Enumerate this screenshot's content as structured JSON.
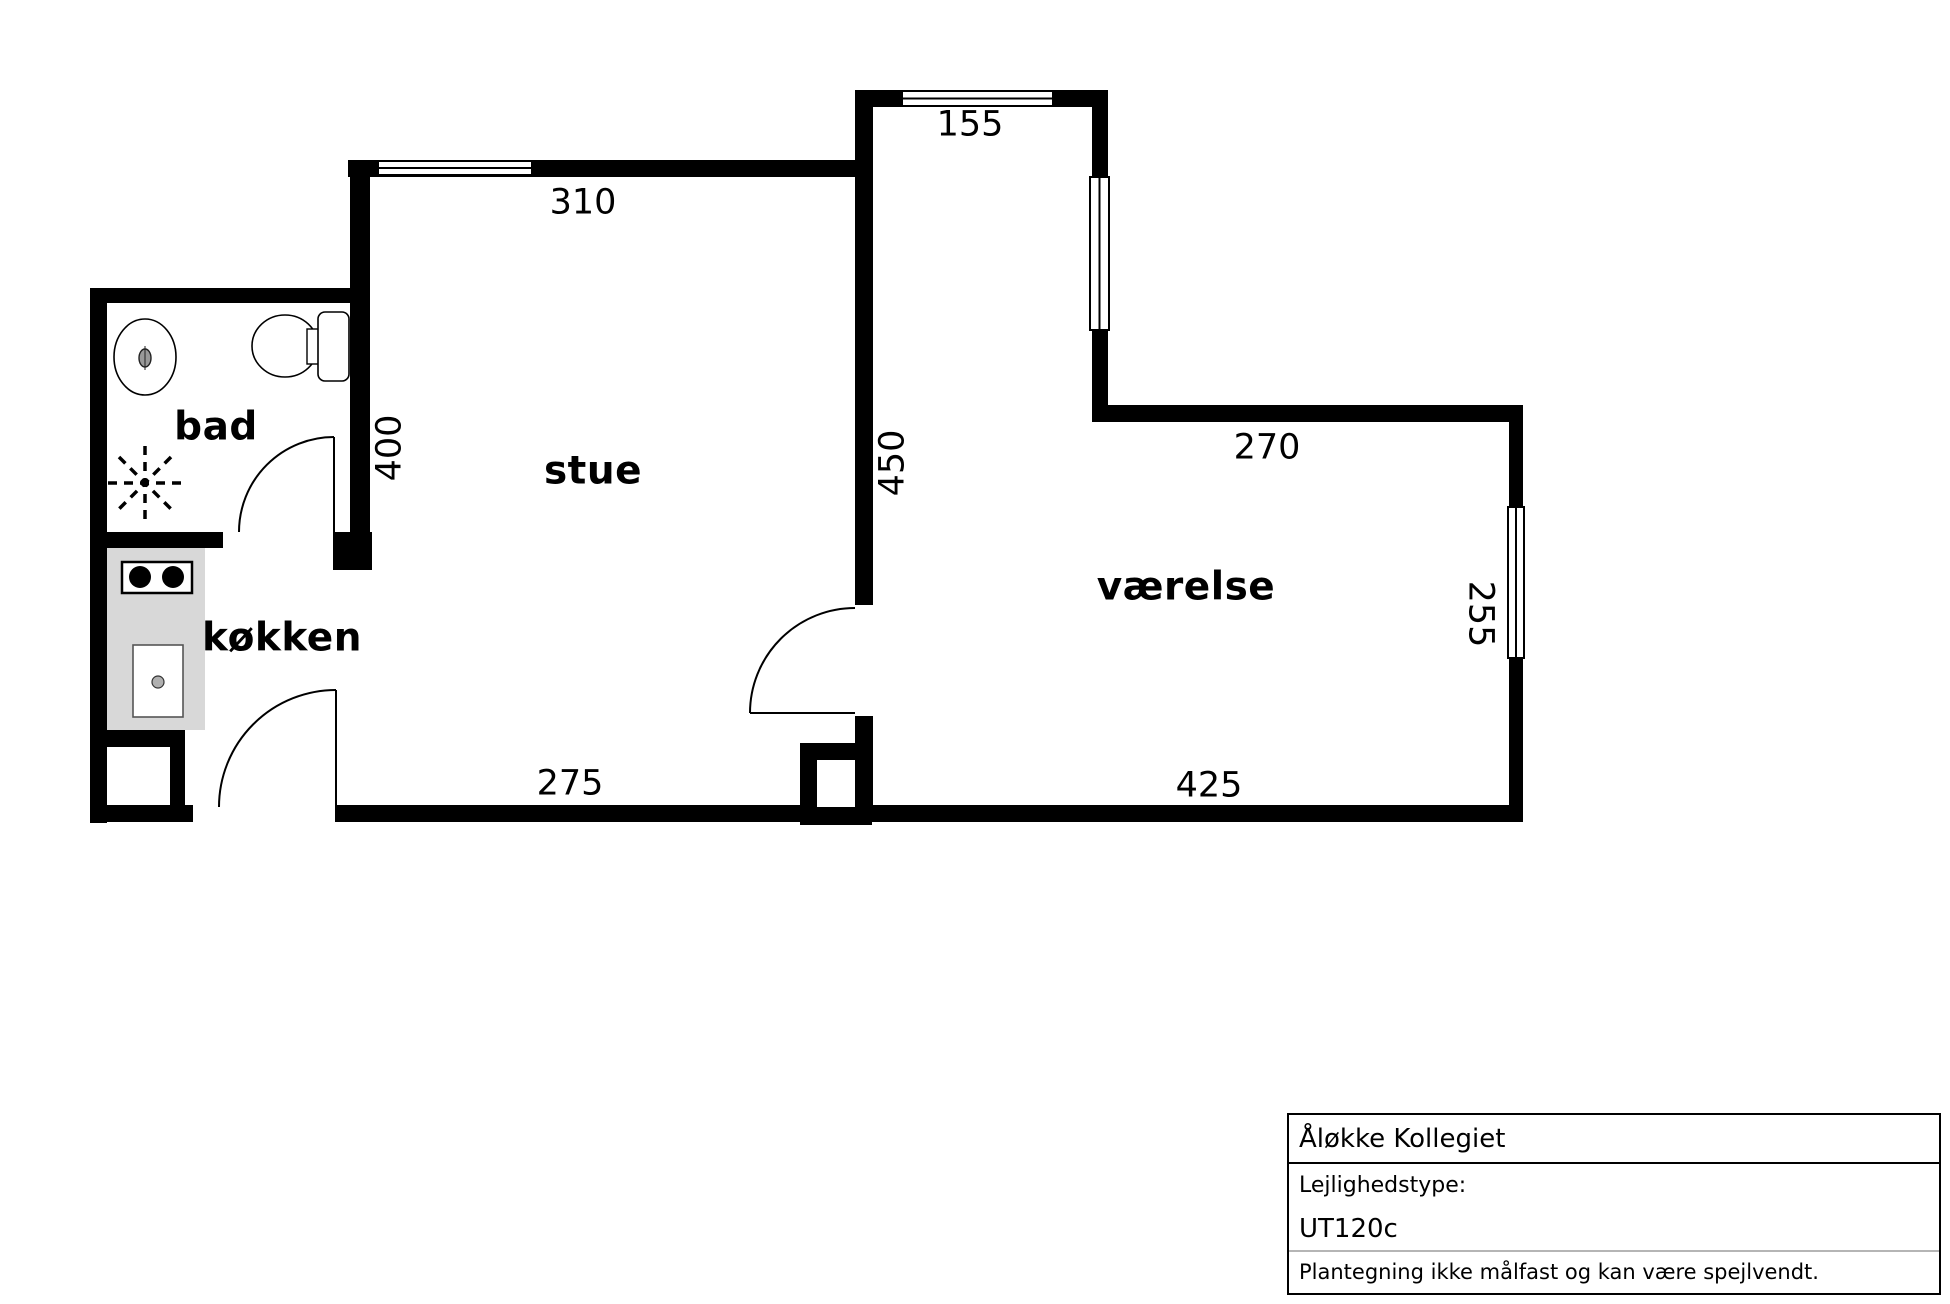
{
  "document": {
    "kind": "apartment-floor-plan"
  },
  "plan": {
    "rooms": [
      {
        "label": "bad"
      },
      {
        "label": "stue"
      },
      {
        "label": "køkken"
      },
      {
        "label": "værelse"
      }
    ],
    "dims": [
      {
        "text": "310"
      },
      {
        "text": "155"
      },
      {
        "text": "400"
      },
      {
        "text": "450"
      },
      {
        "text": "270"
      },
      {
        "text": "255"
      },
      {
        "text": "275"
      },
      {
        "text": "425"
      }
    ],
    "fixtures": [
      "washbasin",
      "toilet",
      "shower",
      "stove",
      "kitchen-sink",
      "kitchen-counter"
    ]
  },
  "info_box": {
    "title": "Åløkke Kollegiet",
    "type_label": "Lejlighedstype:",
    "type_value": "UT120c",
    "note": "Plantegning ikke målfast og kan være spejlvendt."
  },
  "colors": {
    "wall": "#000000",
    "background": "#ffffff",
    "counter": "#d8d8d8",
    "divider_gray": "#b5b5b5"
  }
}
